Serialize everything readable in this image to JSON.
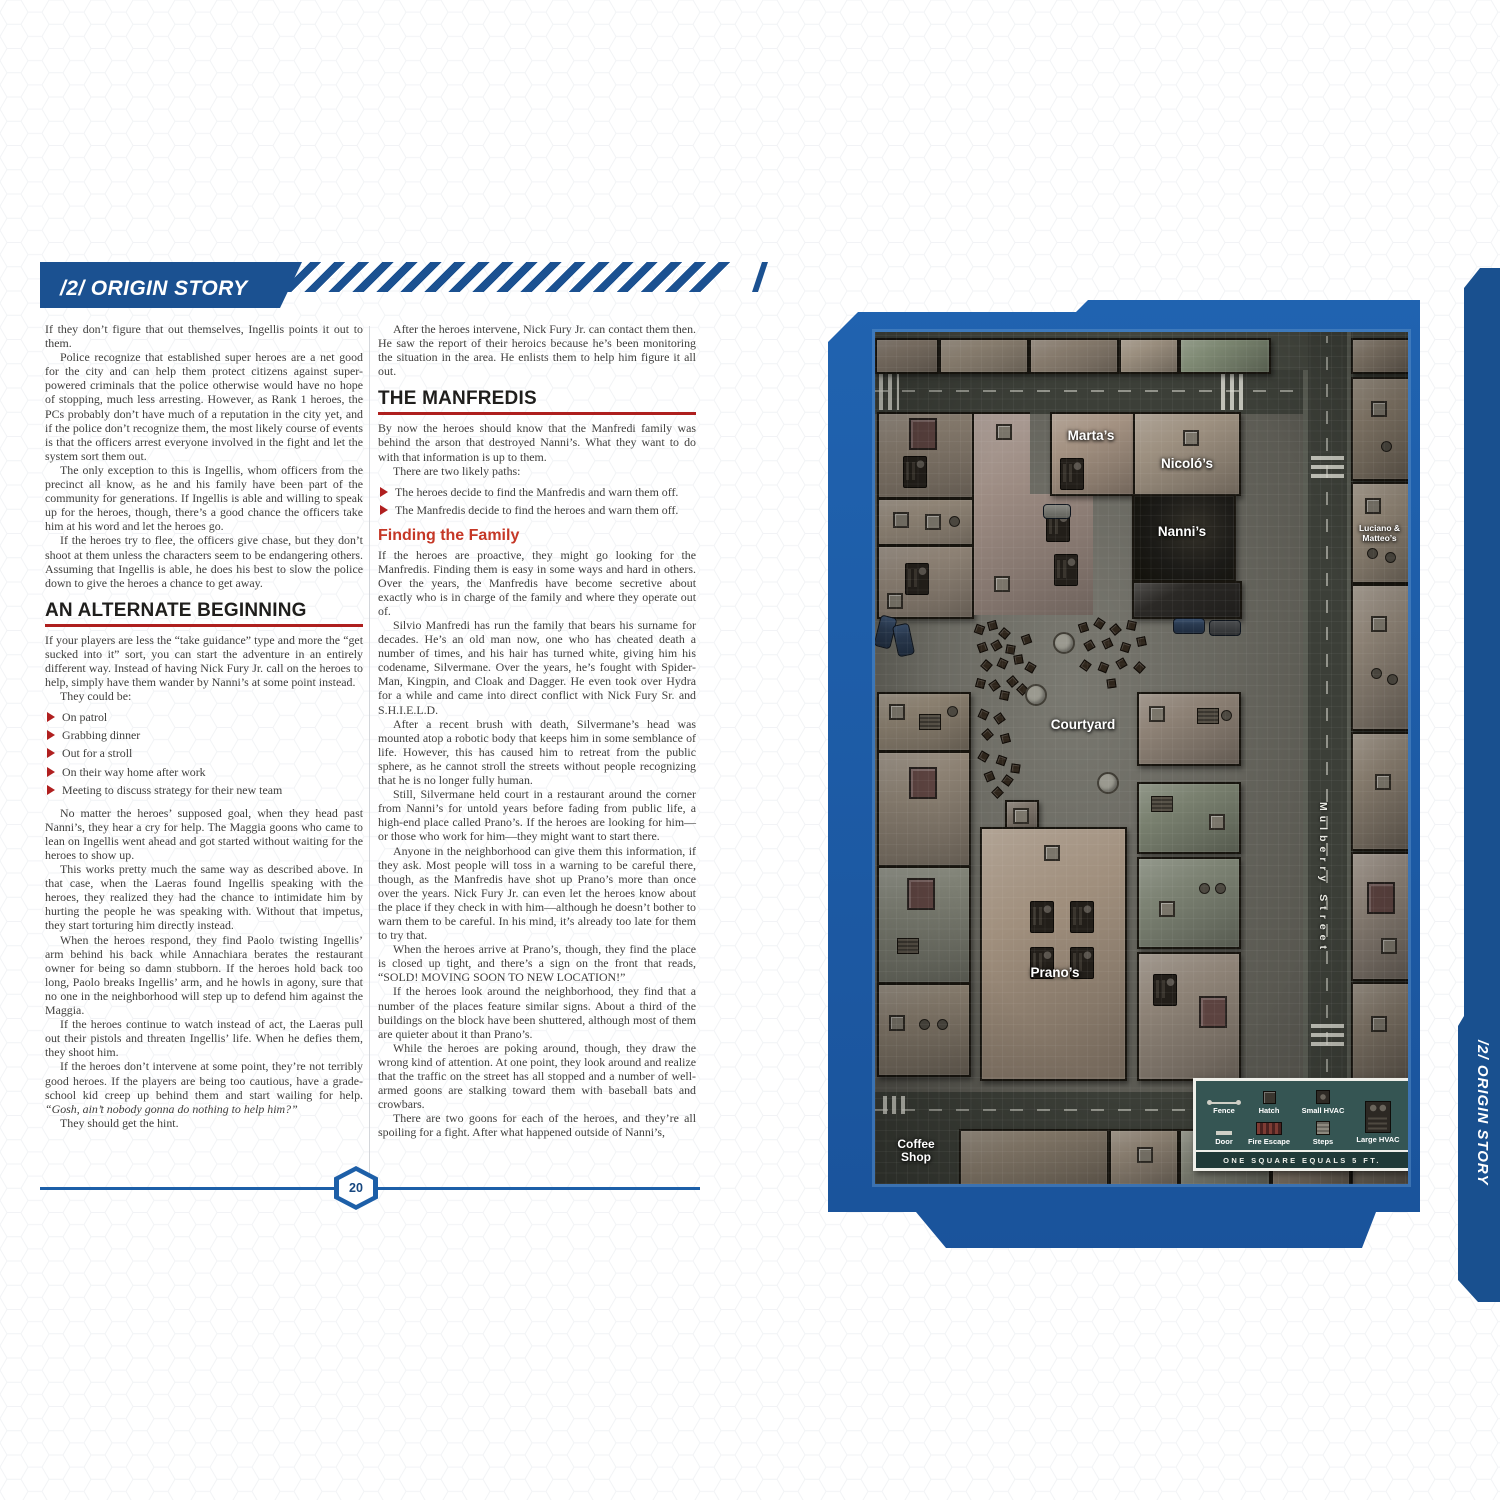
{
  "header": {
    "chapter_label": "/2/ ORIGIN STORY"
  },
  "side_tab": {
    "label": "/2/ ORIGIN STORY"
  },
  "footer": {
    "page_number": "20"
  },
  "col1": {
    "p1": "If they don’t figure that out themselves, Ingellis points it out to them.",
    "p2": "Police recognize that established super heroes are a net good for the city and can help them protect citizens against super-powered criminals that the police otherwise would have no hope of stopping, much less arresting. However, as Rank 1 heroes, the PCs probably don’t have much of a reputation in the city yet, and if the police don’t recognize them, the most likely course of events is that the officers arrest everyone involved in the fight and let the system sort them out.",
    "p3": "The only exception to this is Ingellis, whom officers from the precinct all know, as he and his family have been part of the community for generations. If Ingellis is able and willing to speak up for the heroes, though, there’s a good chance the officers take him at his word and let the heroes go.",
    "p4": "If the heroes try to flee, the officers give chase, but they don’t shoot at them unless the characters seem to be endangering others. Assuming that Ingellis is able, he does his best to slow the police down to give the heroes a chance to get away.",
    "h1": "AN ALTERNATE BEGINNING",
    "p5": "If your players are less the “take guidance” type and more the “get sucked into it” sort, you can start the adventure in an entirely different way. Instead of having Nick Fury Jr. call on the heroes to help, simply have them wander by Nanni’s at some point instead.",
    "p6": "They could be:",
    "bullets": [
      "On patrol",
      "Grabbing dinner",
      "Out for a stroll",
      "On their way home after work",
      "Meeting to discuss strategy for their new team"
    ],
    "p7": "No matter the heroes’ supposed goal, when they head past Nanni’s, they hear a cry for help. The Maggia goons who came to lean on Ingellis went ahead and got started without waiting for the heroes to show up.",
    "p8": "This works pretty much the same way as described above. In that case, when the Laeras found Ingellis speaking with the heroes, they realized they had the chance to intimidate him by hurting the people he was speaking with. Without that impetus, they start torturing him directly instead.",
    "p9": "When the heroes respond, they find Paolo twisting Ingellis’ arm behind his back while Annachiara berates the restaurant owner for being so damn stubborn. If the heroes hold back too long, Paolo breaks Ingellis’ arm, and he howls in agony, sure that no one in the neighborhood will step up to defend him against the Maggia.",
    "p10": "If the heroes continue to watch instead of act, the Laeras pull out their pistols and threaten Ingellis’ life. When he defies them, they shoot him.",
    "p11a": "If the heroes don’t intervene at some point, they’re not terribly good heroes. If the players are being too cautious, have a grade-school kid creep up behind them and start wailing for help. ",
    "p11b": "“Gosh, ain’t nobody gonna do nothing to help him?”",
    "p12": "They should get the hint."
  },
  "col2": {
    "p1": "After the heroes intervene, Nick Fury Jr. can contact them then. He saw the report of their heroics because he’s been monitoring the situation in the area. He enlists them to help him figure it all out.",
    "h1": "THE MANFREDIS",
    "p2": "By now the heroes should know that the Manfredi family was behind the arson that destroyed Nanni’s. What they want to do with that information is up to them.",
    "p3": "There are two likely paths:",
    "bullets": [
      "The heroes decide to find the Manfredis and warn them off.",
      "The Manfredis decide to find the heroes and warn them off."
    ],
    "h2": "Finding the Family",
    "p4": "If the heroes are proactive, they might go looking for the Manfredis. Finding them is easy in some ways and hard in others. Over the years, the Manfredis have become secretive about exactly who is in charge of the family and where they operate out of.",
    "p5": "Silvio Manfredi has run the family that bears his surname for decades. He’s an old man now, one who has cheated death a number of times, and his hair has turned white, giving him his codename, Silvermane. Over the years, he’s fought with Spider-Man, Kingpin, and Cloak and Dagger. He even took over Hydra for a while and came into direct conflict with Nick Fury Sr. and S.H.I.E.L.D.",
    "p6": "After a recent brush with death, Silvermane’s head was mounted atop a robotic body that keeps him in some semblance of life. However, this has caused him to retreat from the public sphere, as he cannot stroll the streets without people recognizing that he is no longer fully human.",
    "p7": "Still, Silvermane held court in a restaurant around the corner from Nanni’s for untold years before fading from public life, a high-end place called Prano’s. If the heroes are looking for him—or those who work for him—they might want to start there.",
    "p8": "Anyone in the neighborhood can give them this information, if they ask. Most people will toss in a warning to be careful there, though, as the Manfredis have shot up Prano’s more than once over the years. Nick Fury Jr. can even let the heroes know about the place if they check in with him—although he doesn’t bother to warn them to be careful. In his mind, it’s already too late for them to try that.",
    "p9": "When the heroes arrive at Prano’s, though, they find the place is closed up tight, and there’s a sign on the front that reads, “SOLD! MOVING SOON TO NEW LOCATION!”",
    "p10": "If the heroes look around the neighborhood, they find that a number of the places feature similar signs. About a third of the buildings on the block have been shuttered, although most of them are quieter about it than Prano’s.",
    "p11": "While the heroes are poking around, though, they draw the wrong kind of attention. At one point, they look around and realize that the traffic on the street has all stopped and a number of well-armed goons are stalking toward them with baseball bats and crowbars.",
    "p12": "There are two goons for each of the heroes, and they’re all spoiling for a fight. After what happened outside of Nanni’s,"
  },
  "map": {
    "labels": {
      "martas": "Marta’s",
      "nicolos": "Nicoló’s",
      "nannis": "Nanni’s",
      "luciano": "Luciano & Matteo’s",
      "courtyard": "Courtyard",
      "pranos": "Prano’s",
      "mulberry": "Mulberry Street",
      "coffee": "Coffee Shop"
    },
    "legend": {
      "fence": "Fence",
      "hatch": "Hatch",
      "small_hvac": "Small HVAC",
      "door": "Door",
      "fire_escape": "Fire Escape",
      "steps": "Steps",
      "large_hvac": "Large HVAC",
      "scale_note": "ONE SQUARE EQUALS 5 FT."
    }
  }
}
